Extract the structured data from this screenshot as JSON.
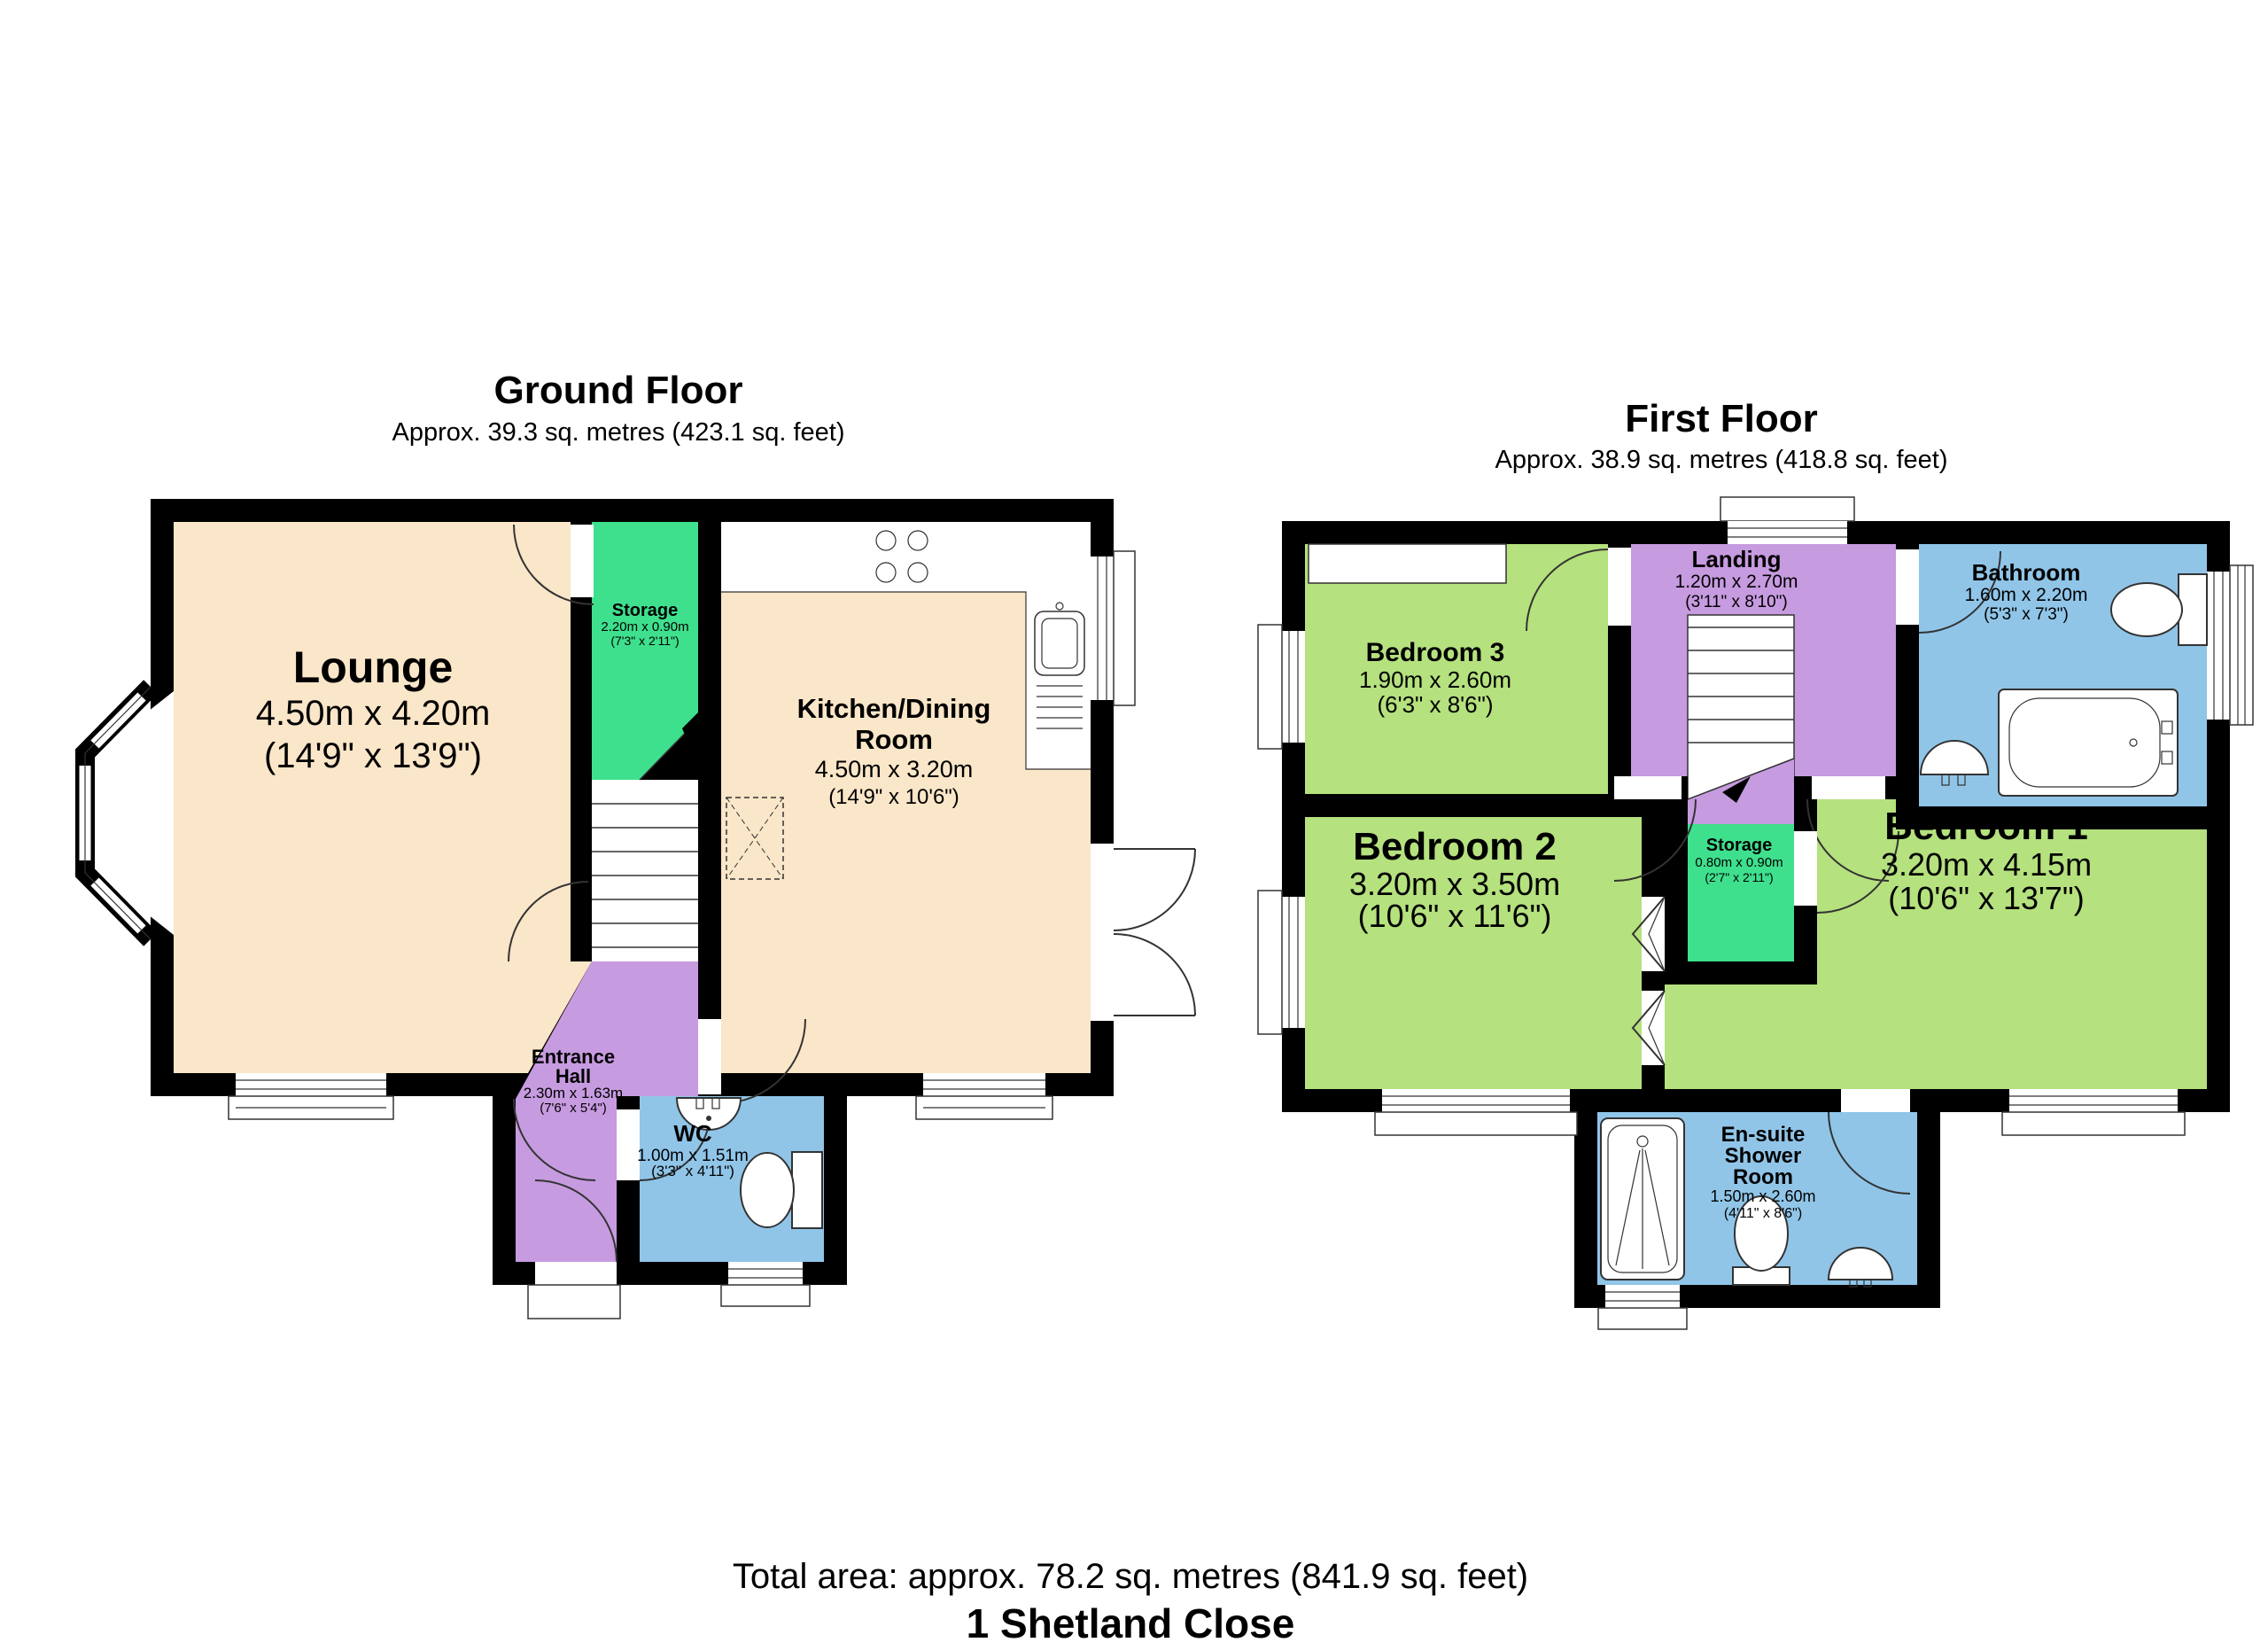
{
  "page": {
    "footer": {
      "total_area": "Total area: approx. 78.2 sq. metres (841.9 sq. feet)",
      "address": "1 Shetland Close"
    }
  },
  "colors": {
    "wall": "#000000",
    "cream_room": "#fae6c8",
    "light_green_room": "#b5e17e",
    "bright_green_room": "#3ee08d",
    "purple_room": "#c79be0",
    "blue_room": "#90c5e8"
  },
  "ground_floor": {
    "title": "Ground Floor",
    "subtitle": "Approx. 39.3 sq. metres (423.1 sq. feet)",
    "rooms": {
      "lounge": {
        "name": "Lounge",
        "dims_m": "4.50m x 4.20m",
        "dims_ft": "(14'9\" x 13'9\")"
      },
      "storage": {
        "name": "Storage",
        "dims_m": "2.20m x 0.90m",
        "dims_ft": "(7'3\" x 2'11\")"
      },
      "kitchen_dining": {
        "name_line1": "Kitchen/Dining",
        "name_line2": "Room",
        "dims_m": "4.50m x 3.20m",
        "dims_ft": "(14'9\" x 10'6\")"
      },
      "entrance_hall": {
        "name_line1": "Entrance",
        "name_line2": "Hall",
        "dims_m": "2.30m x 1.63m",
        "dims_ft": "(7'6\" x 5'4\")"
      },
      "wc": {
        "name": "WC",
        "dims_m": "1.00m x 1.51m",
        "dims_ft": "(3'3\" x 4'11\")"
      }
    }
  },
  "first_floor": {
    "title": "First Floor",
    "subtitle": "Approx. 38.9 sq. metres (418.8 sq. feet)",
    "rooms": {
      "bedroom_3": {
        "name": "Bedroom 3",
        "dims_m": "1.90m x 2.60m",
        "dims_ft": "(6'3\" x 8'6\")"
      },
      "landing": {
        "name": "Landing",
        "dims_m": "1.20m x 2.70m",
        "dims_ft": "(3'11\" x 8'10\")"
      },
      "bathroom": {
        "name": "Bathroom",
        "dims_m": "1.60m x 2.20m",
        "dims_ft": "(5'3\" x 7'3\")"
      },
      "bedroom_2": {
        "name": "Bedroom 2",
        "dims_m": "3.20m x 3.50m",
        "dims_ft": "(10'6\" x 11'6\")"
      },
      "storage": {
        "name": "Storage",
        "dims_m": "0.80m x 0.90m",
        "dims_ft": "(2'7\" x 2'11\")"
      },
      "bedroom_1": {
        "name": "Bedroom 1",
        "dims_m": "3.20m x 4.15m",
        "dims_ft": "(10'6\" x 13'7\")"
      },
      "ensuite": {
        "name_line1": "En-suite",
        "name_line2": "Shower",
        "name_line3": "Room",
        "dims_m": "1.50m x 2.60m",
        "dims_ft": "(4'11\" x 8'6\")"
      }
    }
  }
}
